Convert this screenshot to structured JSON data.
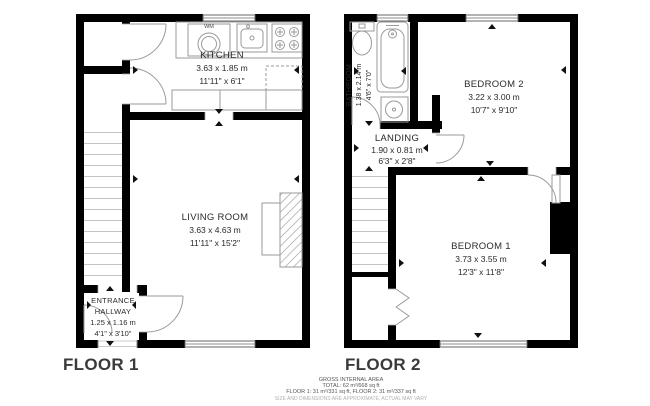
{
  "floor1": {
    "label": "FLOOR 1",
    "kitchen": {
      "name": "KITCHEN",
      "metric": "3.63 x 1.85 m",
      "imperial": "11'11\" x 6'1\""
    },
    "living_room": {
      "name": "LIVING ROOM",
      "metric": "3.63 x 4.63 m",
      "imperial": "11'11\" x 15'2\""
    },
    "entrance_hallway": {
      "name_line1": "ENTRANCE",
      "name_line2": "HALLWAY",
      "metric": "1.25 x 1.16 m",
      "imperial": "4'1\" x 3'10\""
    },
    "washing_machine": "WM"
  },
  "floor2": {
    "label": "FLOOR 2",
    "bathroom": {
      "name": "BATHROOM",
      "metric": "1.38 x 2.14 m",
      "imperial": "4'6\" x 7'0\""
    },
    "bedroom2": {
      "name": "BEDROOM 2",
      "metric": "3.22 x 3.00 m",
      "imperial": "10'7\" x 9'10\""
    },
    "landing": {
      "name": "LANDING",
      "metric": "1.90 x 0.81 m",
      "imperial": "6'3\" x 2'8\""
    },
    "bedroom1": {
      "name": "BEDROOM 1",
      "metric": "3.73 x 3.55 m",
      "imperial": "12'3\" x 11'8\""
    }
  },
  "footer": {
    "line1": "GROSS INTERNAL AREA",
    "line2": "TOTAL: 62 m²/668 sq ft",
    "line3": "FLOOR 1: 31 m²/331 sq ft, FLOOR 2: 31 m²/337 sq ft",
    "line4": "SIZE AND DIMENSIONS ARE APPROXIMATE, ACTUAL MAY VARY"
  },
  "colors": {
    "wall": "#000000",
    "line": "#9a9a9a",
    "text": "#2a2a2a"
  }
}
